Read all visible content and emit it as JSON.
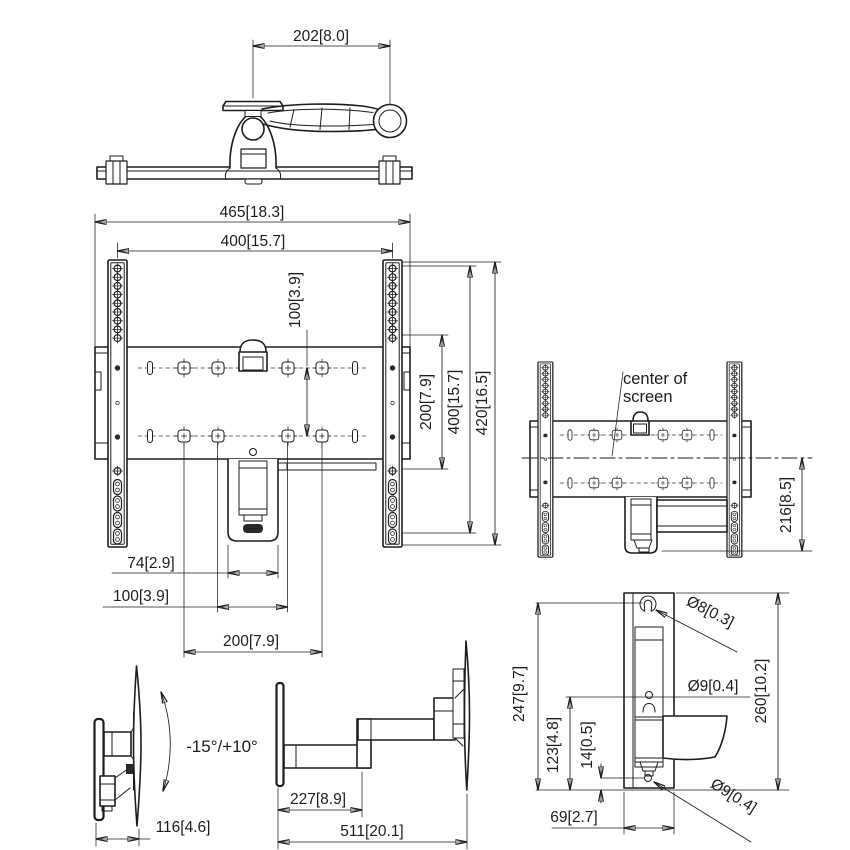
{
  "drawing": {
    "background": "#ffffff",
    "line_color": "#1d1d1b",
    "views": {
      "top": {
        "dim_arm_offset": "202[8.0]"
      },
      "front": {
        "dim_overall_width": "465[18.3]",
        "dim_vesa_width": "400[15.7]",
        "dim_hole_row_gap": "100[3.9]",
        "dim_rail_span_200": "200[7.9]",
        "dim_vesa_height": "400[15.7]",
        "dim_overall_height": "420[16.5]",
        "dim_bracket_width": "74[2.9]",
        "dim_hole_gap_100": "100[3.9]",
        "dim_hole_span_200": "200[7.9]"
      },
      "side": {
        "note_line1": "center of",
        "note_line2": "screen",
        "dim_center_to_bottom": "216[8.5]"
      },
      "tilt": {
        "tilt_range": "-15°/+10°",
        "dim_depth_folded": "116[4.6]"
      },
      "extended": {
        "dim_first_arm": "227[8.9]",
        "dim_max_extension": "511[20.1]"
      },
      "wall_bracket": {
        "dim_keyhole_height": "247[9.7]",
        "dim_hole_spacing": "123[4.8]",
        "dim_hole_to_edge": "14[0.5]",
        "dim_width": "69[2.7]",
        "dim_overall_height": "260[10.2]",
        "dia_keyhole": "Ø8[0.3]",
        "dia_hole_mid": "Ø9[0.4]",
        "dia_hole_bottom": "Ø9[0.4]"
      }
    }
  }
}
